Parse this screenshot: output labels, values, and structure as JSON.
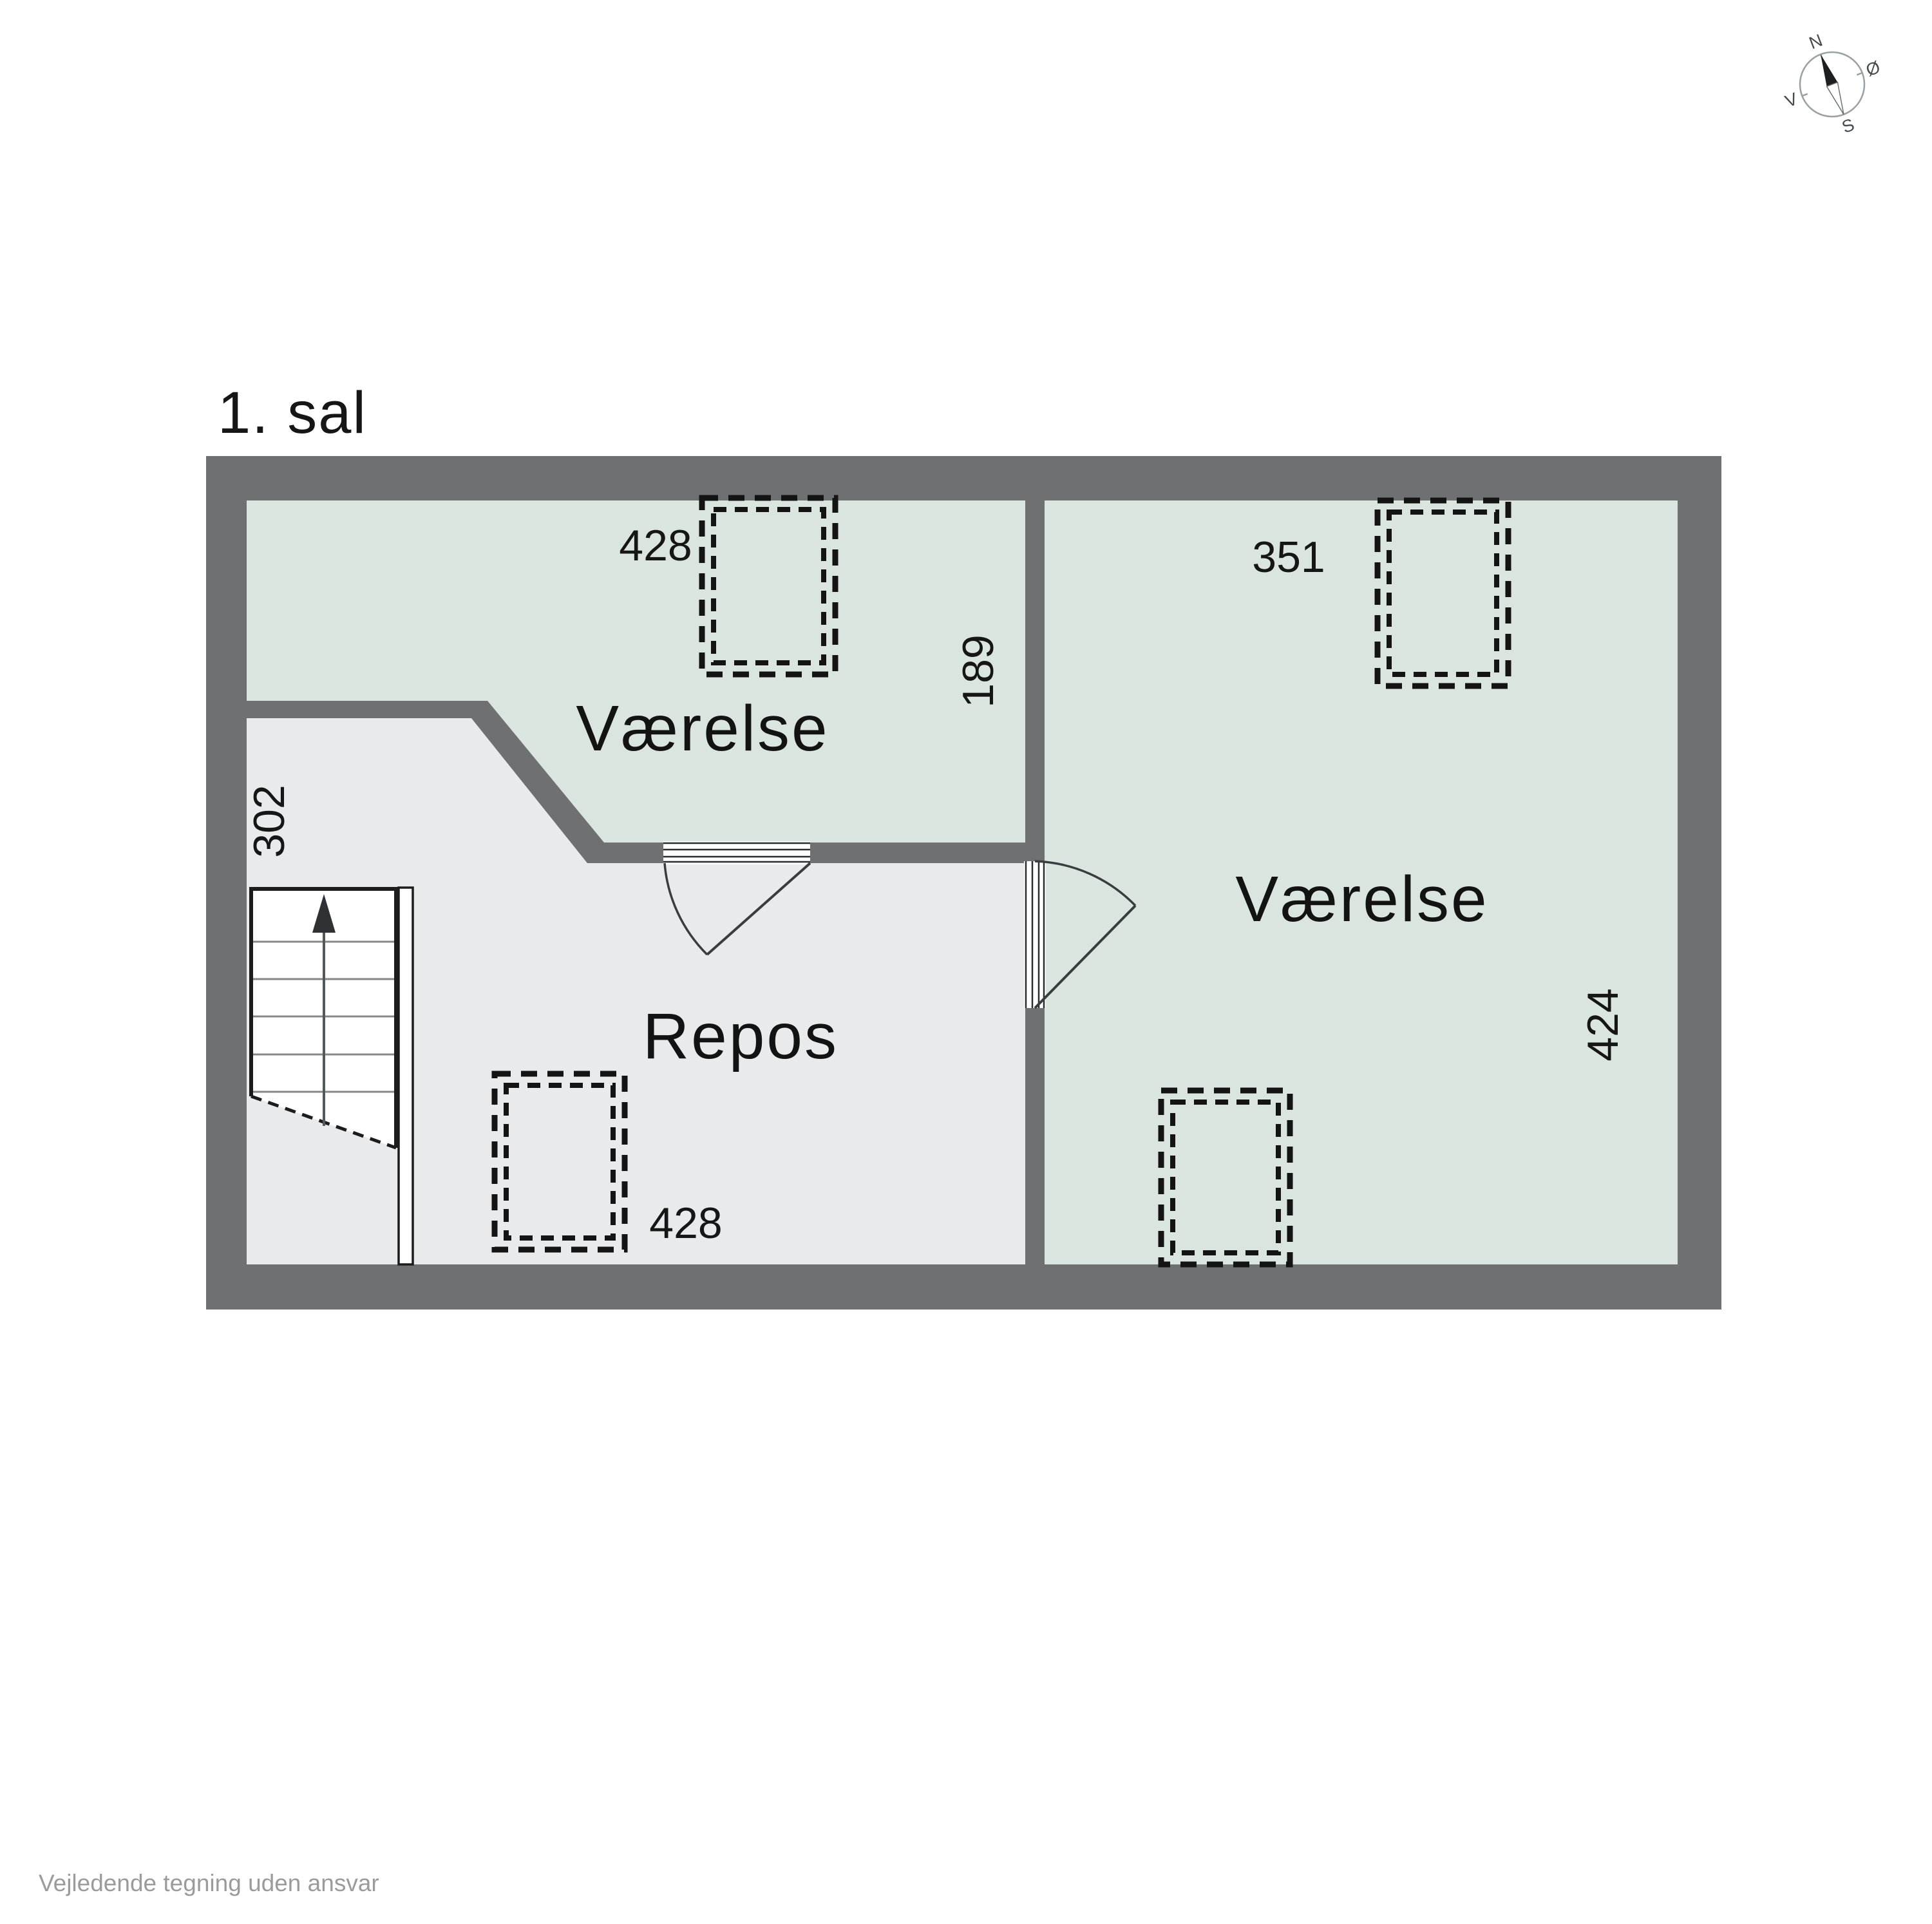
{
  "title": "1. sal",
  "footer": "Vejledende tegning uden ansvar",
  "compass": {
    "north": "N",
    "east": "Ø",
    "south": "S",
    "west": "V"
  },
  "rooms": {
    "room_top_left": {
      "label": "Værelse",
      "width_dim": "428",
      "depth_dim": "189"
    },
    "room_right": {
      "label": "Værelse",
      "width_dim": "351",
      "height_dim": "424"
    },
    "repos": {
      "label": "Repos",
      "width_dim": "428",
      "height_dim": "302"
    }
  },
  "colors": {
    "wall": "#6e7072",
    "room_fill": "#dbe5df",
    "repos_fill": "#e8eaeb",
    "line": "#1c1c1c",
    "tread": "#85888b",
    "footer_gray": "#9b9b9b"
  }
}
